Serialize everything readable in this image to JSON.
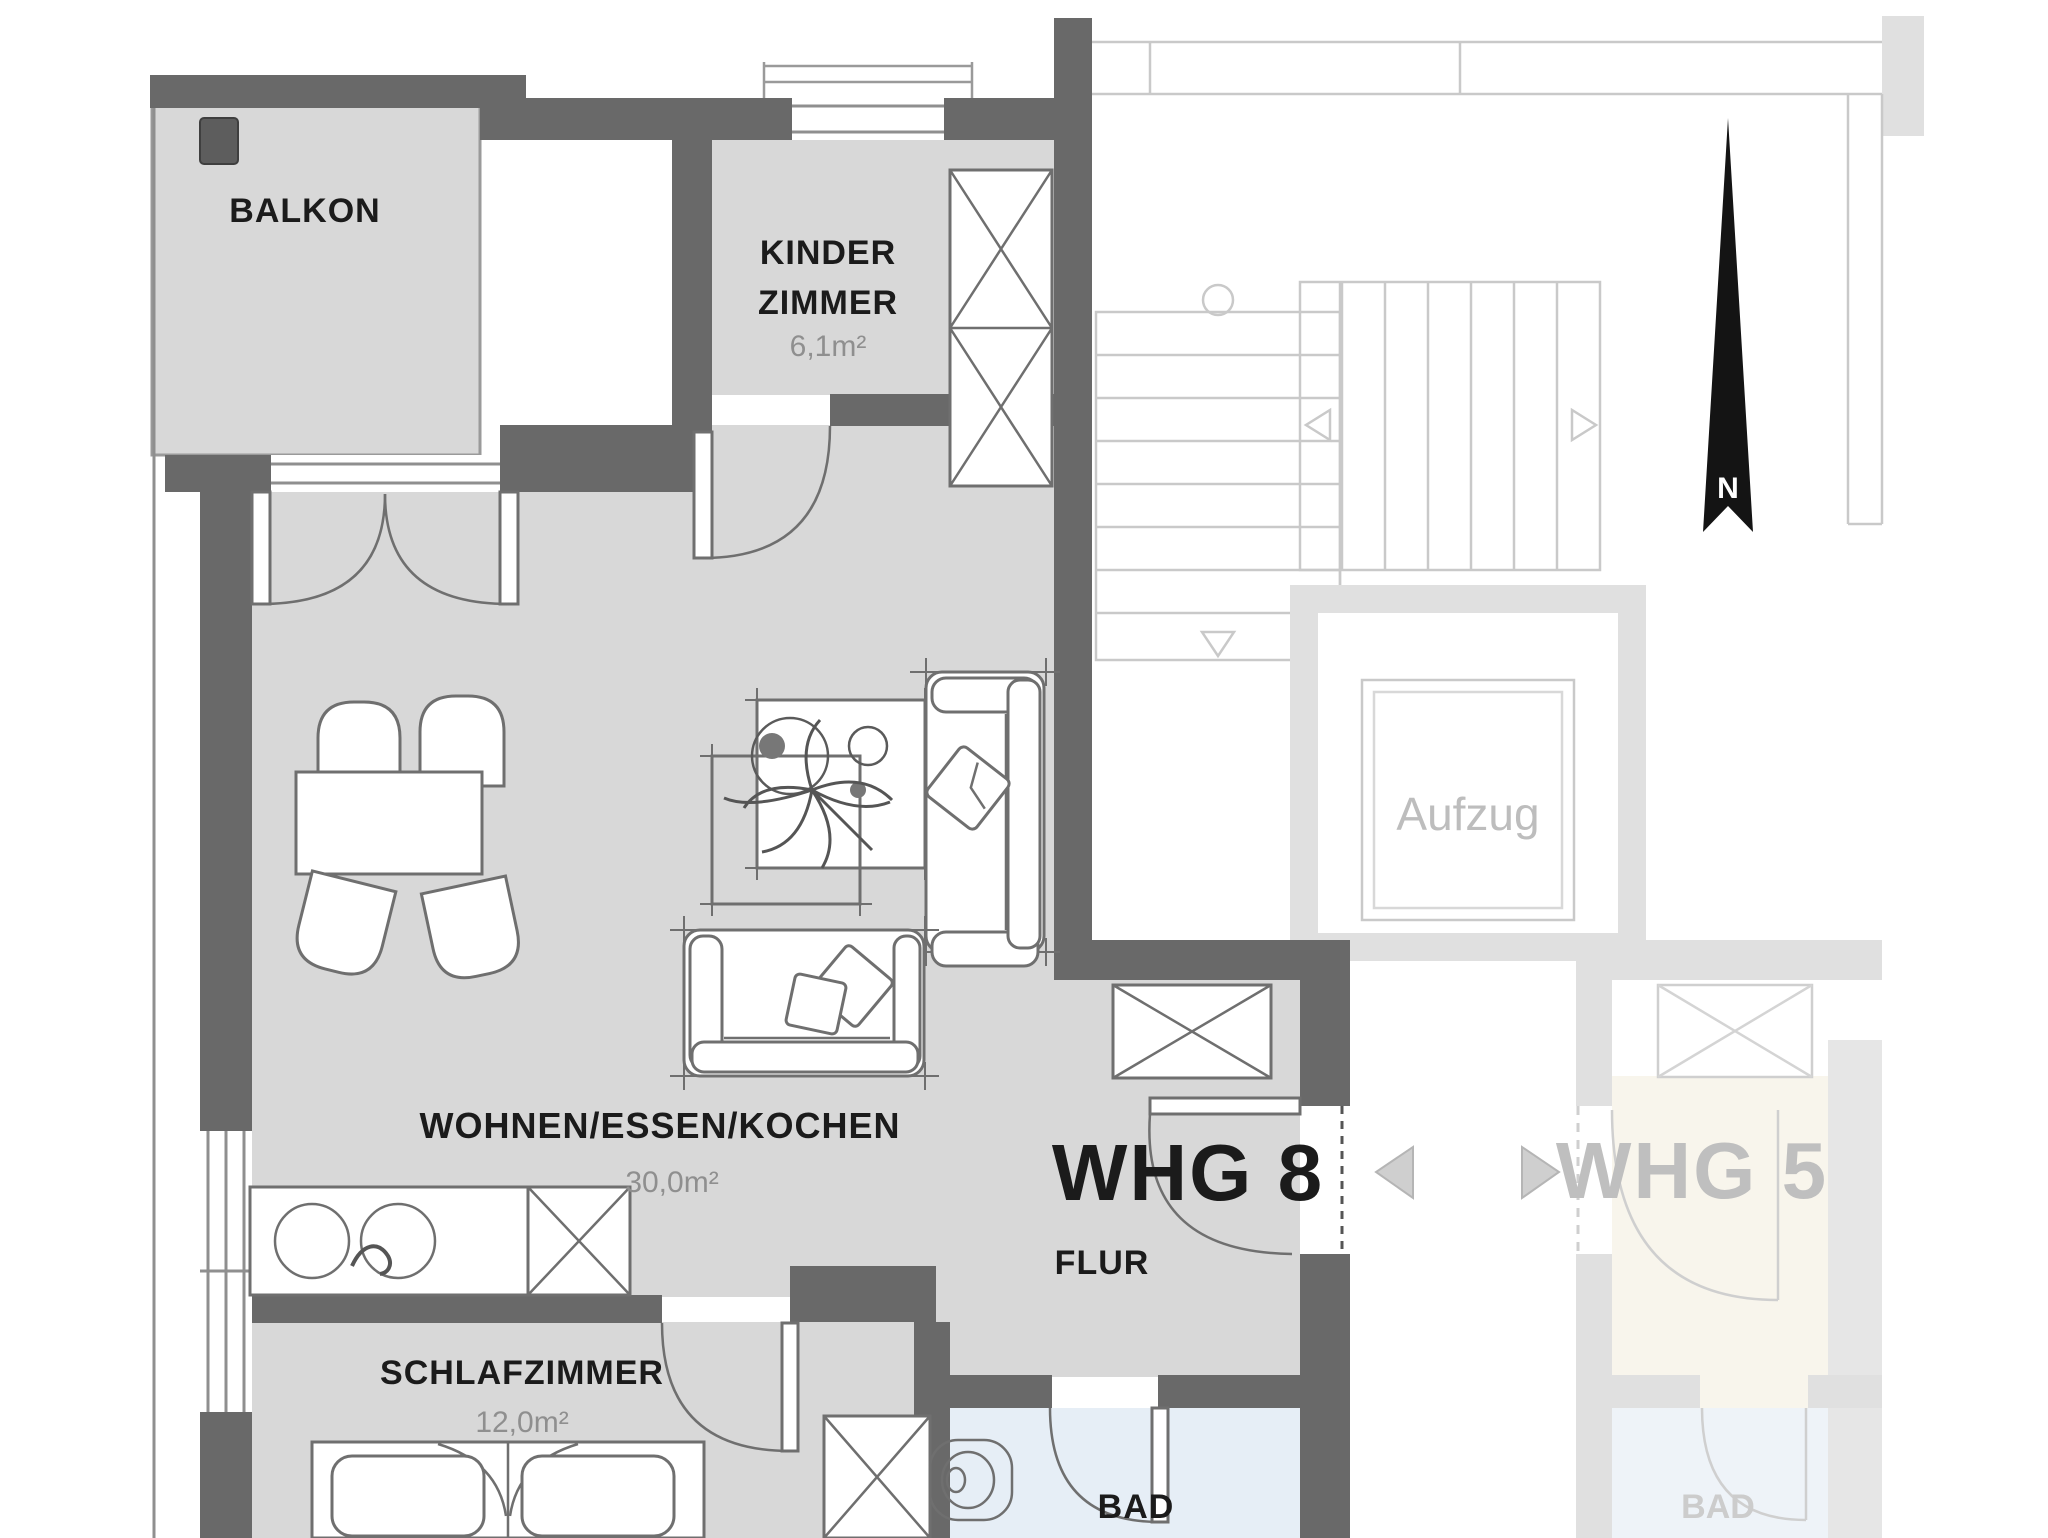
{
  "plan": {
    "unit_label": "WHG 8",
    "neighbor_unit_label": "WHG 5",
    "north_label": "N",
    "elevator_label": "Aufzug",
    "neighbor_bath_label": "BAD"
  },
  "rooms": [
    {
      "name": "balkon",
      "label": "BALKON"
    },
    {
      "name": "kinderzimmer",
      "label_line1": "KINDER",
      "label_line2": "ZIMMER",
      "area": "6,1m²"
    },
    {
      "name": "wohnen_essen_kochen",
      "label": "WOHNEN/ESSEN/KOCHEN",
      "area": "30,0m²"
    },
    {
      "name": "schlafzimmer",
      "label": "SCHLAFZIMMER",
      "area": "12,0m²"
    },
    {
      "name": "flur",
      "label": "FLUR"
    },
    {
      "name": "bad",
      "label": "BAD"
    }
  ],
  "colors": {
    "wall": "#696969",
    "floor": "#d8d8d8",
    "bath_floor": "#e6eef6",
    "faded_lines": "#c9c9c9",
    "label": "#1b1b1b",
    "area_label": "#8f8f8f",
    "north_arrow": "#141414"
  }
}
